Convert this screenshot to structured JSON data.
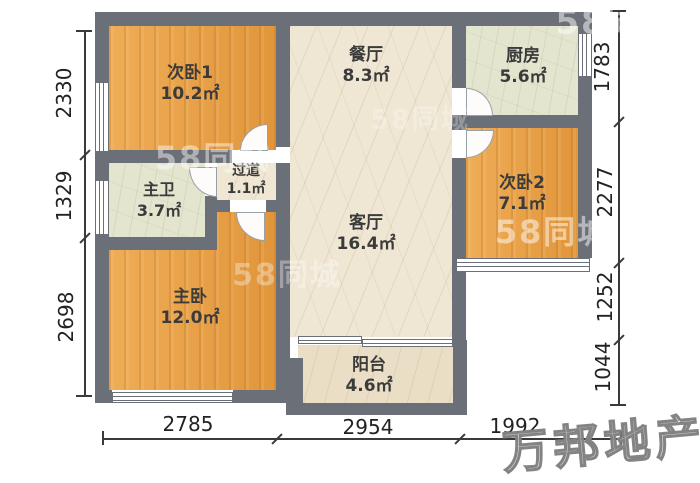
{
  "rooms": [
    {
      "name": "次卧1",
      "area": "10.2㎡"
    },
    {
      "name": "餐厅",
      "area": "8.3㎡"
    },
    {
      "name": "厨房",
      "area": "5.6㎡"
    },
    {
      "name": "主卫",
      "area": "3.7㎡"
    },
    {
      "name": "过道",
      "area": "1.1㎡"
    },
    {
      "name": "次卧2",
      "area": "7.1㎡"
    },
    {
      "name": "客厅",
      "area": "16.4㎡"
    },
    {
      "name": "主卧",
      "area": "12.0㎡"
    },
    {
      "name": "阳台",
      "area": "4.6㎡"
    }
  ],
  "dimensions": {
    "left": [
      "2330",
      "1329",
      "2698"
    ],
    "right": [
      "1783",
      "2277",
      "1252",
      "1044"
    ],
    "bottom": [
      "2785",
      "2954",
      "1992"
    ]
  },
  "watermarks": {
    "site": "58同城",
    "agency": "万邦地产"
  },
  "colors": {
    "wall": "#6b6f77",
    "wood_floor": "#e89f44",
    "marble_floor": "#efe7d3",
    "tile_floor": "#e4e5cf"
  }
}
